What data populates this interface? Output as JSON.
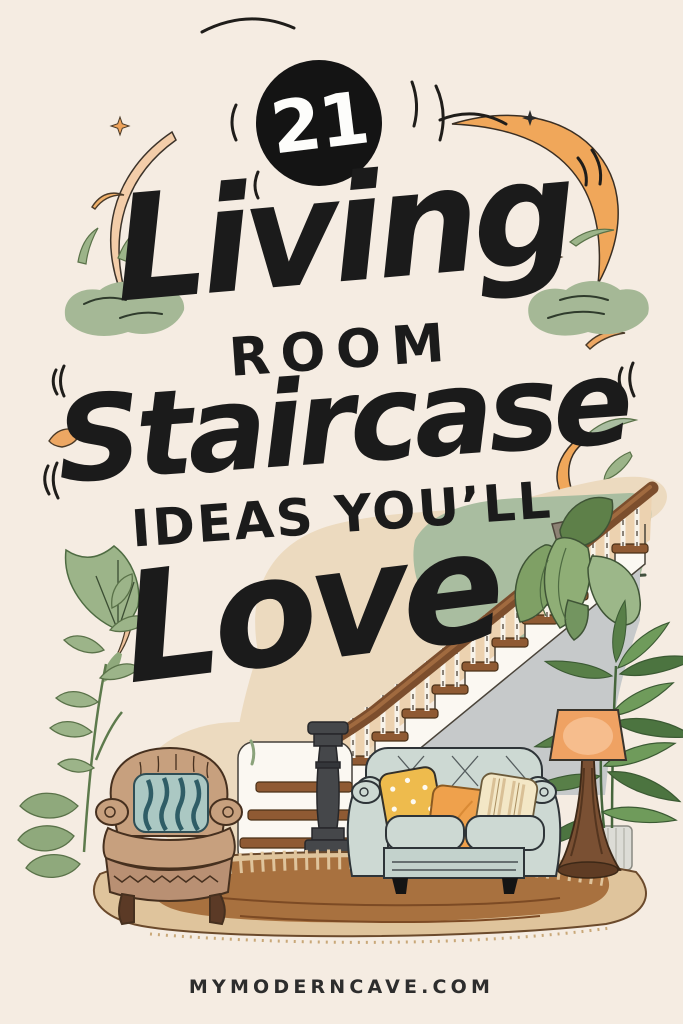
{
  "poster": {
    "badge": {
      "number": "21"
    },
    "title": {
      "line1": "Living",
      "line2": "ROOM",
      "line3": "Staircase",
      "line4": "IDEAS YOU’LL",
      "line5": "Love"
    },
    "footer": {
      "website": "MYMODERNCAVE.COM"
    }
  },
  "colors": {
    "background": "#f5ece2",
    "ink": "#1b1b1b",
    "accent_orange": "#f0a75a",
    "peach": "#f3cda9",
    "sage_green": "#9fb591",
    "accent_wall_green": "#a9bda0",
    "under_stair_gray": "#c6c9ca",
    "stair_wood": "#8f5a33",
    "sofa_sage": "#cdd9d3",
    "pillow_yellow": "#eebb4d",
    "pillow_orange": "#efa14c",
    "pillow_cream": "#f3e7c6",
    "armchair_tan": "#c7a07e",
    "rug_brown": "#a8713f",
    "rug_tan": "#dfc49c",
    "lamp_shade": "#efa263"
  },
  "illustration": {
    "scene": "living room with staircase",
    "objects": [
      "staircase with wood treads",
      "white balusters",
      "wood handrail",
      "dark newel post",
      "green accent wall",
      "hanging plant",
      "sage loveseat sofa",
      "polka-dot pillow",
      "orange pillow",
      "striped cream pillow",
      "tan armchair with teal striped cushion",
      "potted palm",
      "wood floor lamp with orange shade",
      "leafy houseplant",
      "brown area rug",
      "orange crescent moons",
      "sparkles",
      "sage leaves"
    ]
  }
}
